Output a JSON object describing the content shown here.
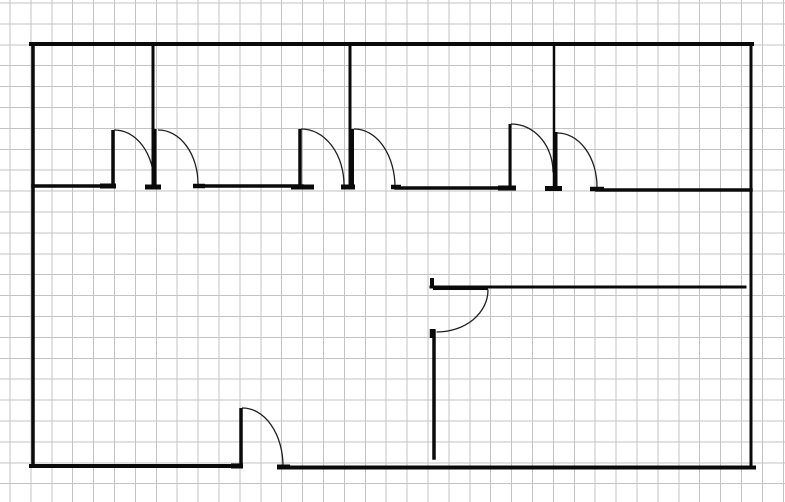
{
  "canvas": {
    "width": 785,
    "height": 502,
    "background": "#ffffff"
  },
  "grid": {
    "spacing": 20.9,
    "offset_x": 10,
    "offset_y": 3,
    "color": "#c3c3c3",
    "stroke_width": 1
  },
  "style": {
    "wall_color": "#0a0a0a",
    "leaf_color": "#0a0a0a",
    "jamb_color": "#0a0a0a",
    "arc_color": "#1f1f1f",
    "arc_stroke_width": 1.3
  },
  "floor_plan": {
    "walls": [
      {
        "id": "exterior-wall-top",
        "x1": 31,
        "y1": 44,
        "x2": 752,
        "y2": 44,
        "w": 4
      },
      {
        "id": "exterior-wall-left",
        "x1": 33,
        "y1": 44,
        "x2": 33,
        "y2": 466,
        "w": 3.5
      },
      {
        "id": "exterior-wall-right",
        "x1": 751,
        "y1": 44,
        "x2": 751,
        "y2": 468,
        "w": 3
      },
      {
        "id": "exterior-wall-bottom-left",
        "x1": 31,
        "y1": 466,
        "x2": 240,
        "y2": 466,
        "w": 4
      },
      {
        "id": "exterior-wall-bottom-right",
        "x1": 283,
        "y1": 467.5,
        "x2": 754,
        "y2": 467.5,
        "w": 4
      },
      {
        "id": "corridor-wall-a",
        "x1": 33,
        "y1": 186,
        "x2": 110,
        "y2": 186,
        "w": 3.5
      },
      {
        "id": "room-divider-1",
        "x1": 153,
        "y1": 44,
        "x2": 153,
        "y2": 188,
        "w": 3
      },
      {
        "id": "corridor-wall-b",
        "x1": 197,
        "y1": 186,
        "x2": 302,
        "y2": 186,
        "w": 3.5
      },
      {
        "id": "room-divider-2",
        "x1": 350,
        "y1": 44,
        "x2": 350,
        "y2": 188,
        "w": 3
      },
      {
        "id": "corridor-wall-c",
        "x1": 396,
        "y1": 188,
        "x2": 512,
        "y2": 188,
        "w": 3.5
      },
      {
        "id": "room-divider-3",
        "x1": 554,
        "y1": 46,
        "x2": 554,
        "y2": 189,
        "w": 2.5
      },
      {
        "id": "corridor-wall-d",
        "x1": 597,
        "y1": 190,
        "x2": 751,
        "y2": 190,
        "w": 3.5
      },
      {
        "id": "lower-room-wall-horizontal",
        "x1": 431,
        "y1": 287,
        "x2": 745,
        "y2": 287,
        "w": 3
      },
      {
        "id": "lower-room-wall-vertical",
        "x1": 434,
        "y1": 331,
        "x2": 434,
        "y2": 458,
        "w": 3.5
      }
    ],
    "door_leaves": [
      {
        "id": "door-1-leaf",
        "x1": 113,
        "y1": 130,
        "x2": 113,
        "y2": 186,
        "w": 3.5
      },
      {
        "id": "door-2-leaf",
        "x1": 155,
        "y1": 129,
        "x2": 155,
        "y2": 187,
        "w": 3
      },
      {
        "id": "door-3-leaf",
        "x1": 300,
        "y1": 129,
        "x2": 300,
        "y2": 187,
        "w": 3.5
      },
      {
        "id": "door-4-leaf",
        "x1": 352.5,
        "y1": 129,
        "x2": 352.5,
        "y2": 187,
        "w": 3
      },
      {
        "id": "door-5-leaf",
        "x1": 510,
        "y1": 124,
        "x2": 510,
        "y2": 188,
        "w": 3
      },
      {
        "id": "door-6-leaf",
        "x1": 556,
        "y1": 132,
        "x2": 556,
        "y2": 188,
        "w": 3
      },
      {
        "id": "door-7-leaf",
        "x1": 241,
        "y1": 408,
        "x2": 241,
        "y2": 465,
        "w": 3.5
      },
      {
        "id": "door-8-leaf",
        "x1": 433,
        "y1": 288,
        "x2": 488,
        "y2": 288,
        "w": 4
      }
    ],
    "door_jambs": [
      {
        "id": "jamb-wall-a-end",
        "x1": 100,
        "y1": 186,
        "x2": 116,
        "y2": 186,
        "w": 5
      },
      {
        "id": "jamb-divider-1-base",
        "x1": 145,
        "y1": 187,
        "x2": 161,
        "y2": 187,
        "w": 5
      },
      {
        "id": "jamb-wall-b-start",
        "x1": 193,
        "y1": 186,
        "x2": 205,
        "y2": 186,
        "w": 4.5
      },
      {
        "id": "jamb-wall-b-end",
        "x1": 291,
        "y1": 187,
        "x2": 314,
        "y2": 187,
        "w": 5
      },
      {
        "id": "jamb-divider-2-base",
        "x1": 341,
        "y1": 187,
        "x2": 355,
        "y2": 187,
        "w": 5
      },
      {
        "id": "jamb-wall-c-start",
        "x1": 391,
        "y1": 187,
        "x2": 401,
        "y2": 187,
        "w": 4.5
      },
      {
        "id": "jamb-wall-c-end",
        "x1": 498,
        "y1": 188,
        "x2": 516,
        "y2": 188,
        "w": 5
      },
      {
        "id": "jamb-divider-3-base",
        "x1": 545,
        "y1": 188.5,
        "x2": 562,
        "y2": 188.5,
        "w": 5
      },
      {
        "id": "jamb-wall-d-start",
        "x1": 590,
        "y1": 189,
        "x2": 604,
        "y2": 189,
        "w": 4.5
      },
      {
        "id": "jamb-bottom-door-left",
        "x1": 231,
        "y1": 466,
        "x2": 243,
        "y2": 466,
        "w": 5
      },
      {
        "id": "jamb-bottom-door-right",
        "x1": 277,
        "y1": 467,
        "x2": 290,
        "y2": 467,
        "w": 5
      },
      {
        "id": "jamb-lower-wall-left-end",
        "x1": 432,
        "y1": 278,
        "x2": 432,
        "y2": 287,
        "w": 4
      },
      {
        "id": "jamb-lower-wall-top",
        "x1": 432.5,
        "y1": 329,
        "x2": 432.5,
        "y2": 338,
        "w": 5.5
      }
    ],
    "door_swing_arcs": [
      {
        "id": "door-1-arc",
        "x1": 114.5,
        "y1": 130,
        "rx": 39.5,
        "ry": 53,
        "x2": 154,
        "y2": 183,
        "sweep": 1
      },
      {
        "id": "door-2-arc",
        "x1": 158.5,
        "y1": 130,
        "rx": 39.5,
        "ry": 54,
        "x2": 198,
        "y2": 184,
        "sweep": 1
      },
      {
        "id": "door-3-arc",
        "x1": 301.5,
        "y1": 129,
        "rx": 42.5,
        "ry": 56,
        "x2": 344,
        "y2": 185,
        "sweep": 1
      },
      {
        "id": "door-4-arc",
        "x1": 354.5,
        "y1": 129,
        "rx": 40.5,
        "ry": 58,
        "x2": 395,
        "y2": 187,
        "sweep": 1
      },
      {
        "id": "door-5-arc",
        "x1": 511.5,
        "y1": 124,
        "rx": 41.5,
        "ry": 48,
        "x2": 553,
        "y2": 172,
        "sweep": 1
      },
      {
        "id": "door-6-arc",
        "x1": 557.5,
        "y1": 133,
        "rx": 39.5,
        "ry": 54,
        "x2": 597,
        "y2": 187,
        "sweep": 1
      },
      {
        "id": "door-7-arc",
        "x1": 242.5,
        "y1": 408,
        "rx": 40.5,
        "ry": 58,
        "x2": 283,
        "y2": 466,
        "sweep": 1
      },
      {
        "id": "door-8-arc",
        "x1": 488,
        "y1": 290,
        "rx": 51,
        "ry": 42,
        "x2": 437,
        "y2": 332,
        "sweep": 1
      }
    ]
  }
}
